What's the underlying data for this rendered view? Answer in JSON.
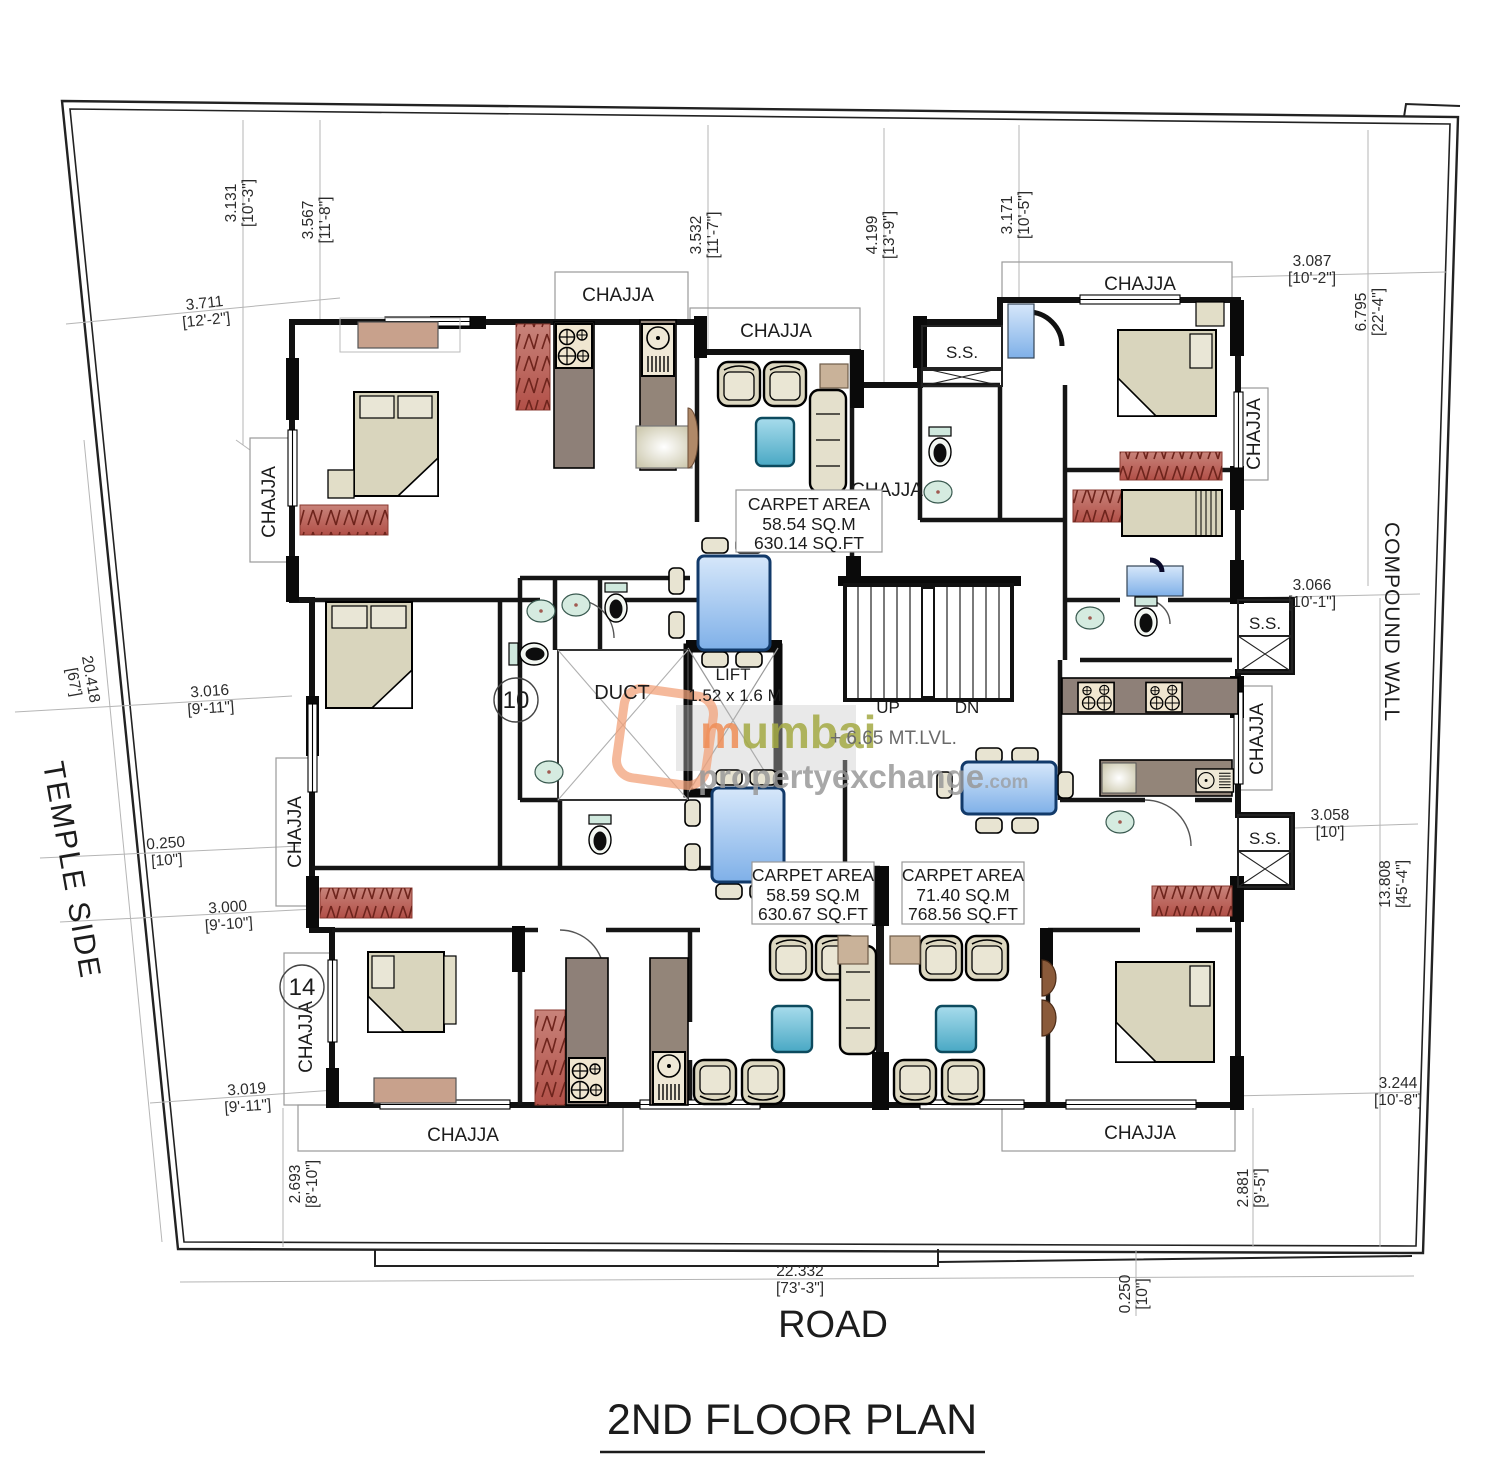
{
  "title": "2ND FLOOR PLAN",
  "labels": {
    "road": "ROAD",
    "temple_side": "TEMPLE SIDE",
    "compound_wall": "COMPOUND WALL",
    "chajja": "CHAJJA",
    "ss": "S.S.",
    "duct": "DUCT",
    "lift": "LIFT",
    "lift_size": "1.52 x 1.6 M",
    "up": "UP",
    "dn": "DN",
    "level": "+ 6.65 MT.LVL."
  },
  "door_numbers": {
    "left_unit": "14",
    "center_unit": "10"
  },
  "carpet_areas": [
    {
      "heading": "CARPET AREA",
      "sqm": "58.54 SQ.M",
      "sqft": "630.14 SQ.FT"
    },
    {
      "heading": "CARPET AREA",
      "sqm": "58.59 SQ.M",
      "sqft": "630.67 SQ.FT"
    },
    {
      "heading": "CARPET AREA",
      "sqm": "71.40 SQ.M",
      "sqft": "768.56 SQ.FT"
    }
  ],
  "dimensions": [
    {
      "m": "3.131",
      "ft": "[10'-3\"]"
    },
    {
      "m": "3.567",
      "ft": "[11'-8\"]"
    },
    {
      "m": "3.711",
      "ft": "[12'-2\"]"
    },
    {
      "m": "3.532",
      "ft": "[11'-7\"]"
    },
    {
      "m": "4.199",
      "ft": "[13'-9\"]"
    },
    {
      "m": "3.171",
      "ft": "[10'-5\"]"
    },
    {
      "m": "3.087",
      "ft": "[10'-2\"]"
    },
    {
      "m": "6.795",
      "ft": "[22'-4\"]"
    },
    {
      "m": "20.418",
      "ft": "[67']"
    },
    {
      "m": "3.016",
      "ft": "[9'-11\"]"
    },
    {
      "m": "0.250",
      "ft": "[10\"]"
    },
    {
      "m": "3.000",
      "ft": "[9'-10\"]"
    },
    {
      "m": "3.019",
      "ft": "[9'-11\"]"
    },
    {
      "m": "2.693",
      "ft": "[8'-10\"]"
    },
    {
      "m": "3.066",
      "ft": "[10'-1\"]"
    },
    {
      "m": "3.058",
      "ft": "[10']"
    },
    {
      "m": "13.808",
      "ft": "[45'-4\"]"
    },
    {
      "m": "3.244",
      "ft": "[10'-8\"]"
    },
    {
      "m": "2.881",
      "ft": "[9'-5\"]"
    },
    {
      "m": "22.332",
      "ft": "[73'-3\"]"
    },
    {
      "m": "0.250",
      "ft": "[10\"]"
    }
  ],
  "watermark": {
    "brand_initial": "m",
    "brand_rest": "umbai",
    "line2": "propertyexchange",
    "suffix": ".com"
  },
  "colors": {
    "wall": "#111111",
    "wardrobe_red": "#b9625a",
    "furniture_beige": "#d9d5bd",
    "counter_gray": "#8e8078",
    "table_blue": "#8fb8ea",
    "aqua": "#5cb6d2",
    "fixture_teal": "#cfe8dd",
    "dim_line_gray": "#b5b5b5",
    "watermark_orange": "#ef8e57",
    "watermark_olive": "#a4aa44"
  }
}
